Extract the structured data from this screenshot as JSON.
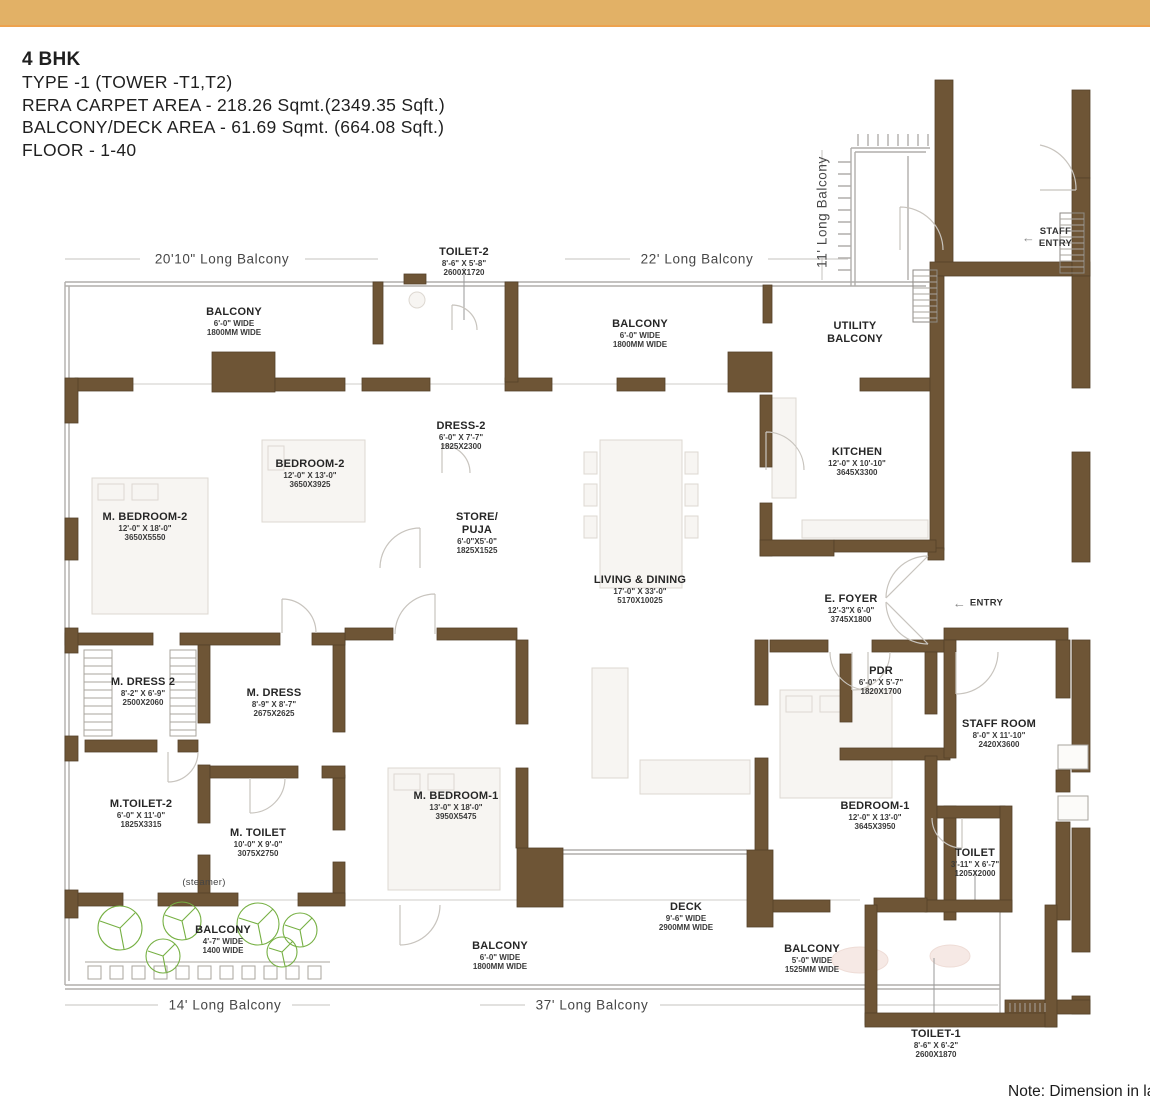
{
  "banner": {
    "color": "#e2b166"
  },
  "header": {
    "title": "4 BHK",
    "lines": [
      "TYPE -1 (TOWER -T1,T2)",
      "RERA CARPET AREA - 218.26 Sqmt.(2349.35 Sqft.)",
      "BALCONY/DECK AREA - 61.69 Sqmt. (664.08 Sqft.)",
      "FLOOR - 1-40"
    ]
  },
  "note": "Note: Dimension in lay",
  "plan": {
    "wall_color": "#6e5536",
    "rail_color": "#b0aeab",
    "plant_color": "#76b043",
    "rooms": [
      {
        "id": "toilet-2",
        "lines": [
          "TOILET-2"
        ],
        "dims": [
          "8'-6\" X 5'-8\"",
          "2600X1720"
        ],
        "x": 464,
        "y": 246
      },
      {
        "id": "balcony-top-left",
        "lines": [
          "BALCONY"
        ],
        "dims": [
          "6'-0\" WIDE",
          "1800MM WIDE"
        ],
        "x": 234,
        "y": 306
      },
      {
        "id": "balcony-top-mid",
        "lines": [
          "BALCONY"
        ],
        "dims": [
          "6'-0\" WIDE",
          "1800MM WIDE"
        ],
        "x": 640,
        "y": 318
      },
      {
        "id": "utility-balcony",
        "lines": [
          "UTILITY",
          "BALCONY"
        ],
        "dims": [],
        "x": 855,
        "y": 320
      },
      {
        "id": "dress-2",
        "lines": [
          "DRESS-2"
        ],
        "dims": [
          "6'-0\" X 7'-7\"",
          "1825X2300"
        ],
        "x": 461,
        "y": 420
      },
      {
        "id": "bedroom-2",
        "lines": [
          "BEDROOM-2"
        ],
        "dims": [
          "12'-0\" X 13'-0\"",
          "3650X3925"
        ],
        "x": 310,
        "y": 458
      },
      {
        "id": "kitchen",
        "lines": [
          "KITCHEN"
        ],
        "dims": [
          "12'-0\" X 10'-10\"",
          "3645X3300"
        ],
        "x": 857,
        "y": 446
      },
      {
        "id": "m-bedroom-2",
        "lines": [
          "M. BEDROOM-2"
        ],
        "dims": [
          "12'-0\" X 18'-0\"",
          "3650X5550"
        ],
        "x": 145,
        "y": 511
      },
      {
        "id": "store-puja",
        "lines": [
          "STORE/",
          "PUJA"
        ],
        "dims": [
          "6'-0\"X5'-0\"",
          "1825X1525"
        ],
        "x": 477,
        "y": 511
      },
      {
        "id": "living-dining",
        "lines": [
          "LIVING & DINING"
        ],
        "dims": [
          "17'-0\" X 33'-0\"",
          "5170X10025"
        ],
        "x": 640,
        "y": 574
      },
      {
        "id": "e-foyer",
        "lines": [
          "E. FOYER"
        ],
        "dims": [
          "12'-3\"X 6'-0\"",
          "3745X1800"
        ],
        "x": 851,
        "y": 593
      },
      {
        "id": "pdr",
        "lines": [
          "PDR"
        ],
        "dims": [
          "6'-0\" X 5'-7\"",
          "1820X1700"
        ],
        "x": 881,
        "y": 665
      },
      {
        "id": "m-dress-2",
        "lines": [
          "M. DRESS 2"
        ],
        "dims": [
          "8'-2\" X 6'-9\"",
          "2500X2060"
        ],
        "x": 143,
        "y": 676
      },
      {
        "id": "m-dress",
        "lines": [
          "M. DRESS"
        ],
        "dims": [
          "8'-9\" X 8'-7\"",
          "2675X2625"
        ],
        "x": 274,
        "y": 687
      },
      {
        "id": "staff-room",
        "lines": [
          "STAFF ROOM"
        ],
        "dims": [
          "8'-0\" X 11'-10\"",
          "2420X3600"
        ],
        "x": 999,
        "y": 718
      },
      {
        "id": "m-toilet-2",
        "lines": [
          "M.TOILET-2"
        ],
        "dims": [
          "6'-0\" X 11'-0\"",
          "1825X3315"
        ],
        "x": 141,
        "y": 798
      },
      {
        "id": "m-bedroom-1",
        "lines": [
          "M. BEDROOM-1"
        ],
        "dims": [
          "13'-0\" X 18'-0\"",
          "3950X5475"
        ],
        "x": 456,
        "y": 790
      },
      {
        "id": "bedroom-1",
        "lines": [
          "BEDROOM-1"
        ],
        "dims": [
          "12'-0\" X 13'-0\"",
          "3645X3950"
        ],
        "x": 875,
        "y": 800
      },
      {
        "id": "m-toilet",
        "lines": [
          "M. TOILET"
        ],
        "dims": [
          "10'-0\" X 9'-0\"",
          "3075X2750"
        ],
        "x": 258,
        "y": 827
      },
      {
        "id": "toilet",
        "lines": [
          "TOILET"
        ],
        "dims": [
          "3'-11\" X 6'-7\"",
          "1205X2000"
        ],
        "x": 975,
        "y": 847
      },
      {
        "id": "deck",
        "lines": [
          "DECK"
        ],
        "dims": [
          "9'-6\" WIDE",
          "2900MM WIDE"
        ],
        "x": 686,
        "y": 901
      },
      {
        "id": "balcony-bottom-left",
        "lines": [
          "BALCONY"
        ],
        "dims": [
          "4'-7\" WIDE",
          "1400 WIDE"
        ],
        "x": 223,
        "y": 924
      },
      {
        "id": "balcony-bottom-mid",
        "lines": [
          "BALCONY"
        ],
        "dims": [
          "6'-0\" WIDE",
          "1800MM WIDE"
        ],
        "x": 500,
        "y": 940
      },
      {
        "id": "balcony-bottom-right",
        "lines": [
          "BALCONY"
        ],
        "dims": [
          "5'-0\" WIDE",
          "1525MM WIDE"
        ],
        "x": 812,
        "y": 943
      },
      {
        "id": "toilet-1",
        "lines": [
          "TOILET-1"
        ],
        "dims": [
          "8'-6\" X 6'-2\"",
          "2600X1870"
        ],
        "x": 936,
        "y": 1028
      }
    ],
    "perimeter_labels": [
      {
        "id": "balcony-20-10",
        "text": "20'10\" Long Balcony",
        "x": 222,
        "y": 259,
        "vertical": false
      },
      {
        "id": "balcony-22",
        "text": "22' Long Balcony",
        "x": 697,
        "y": 259,
        "vertical": false
      },
      {
        "id": "balcony-11",
        "text": "11' Long Balcony",
        "x": 822,
        "y": 212,
        "vertical": true
      },
      {
        "id": "balcony-14",
        "text": "14' Long Balcony",
        "x": 225,
        "y": 1005,
        "vertical": false
      },
      {
        "id": "balcony-37",
        "text": "37' Long Balcony",
        "x": 592,
        "y": 1005,
        "vertical": false
      }
    ],
    "annotations": [
      {
        "id": "staff-entry",
        "lines": [
          "STAFF",
          "ENTRY"
        ],
        "arrow": true,
        "x": 1047,
        "y": 238
      },
      {
        "id": "entry",
        "lines": [
          "ENTRY"
        ],
        "arrow": true,
        "x": 978,
        "y": 603
      },
      {
        "id": "steamer",
        "lines": [
          "(steamer)"
        ],
        "arrow": false,
        "x": 204,
        "y": 883
      }
    ]
  }
}
